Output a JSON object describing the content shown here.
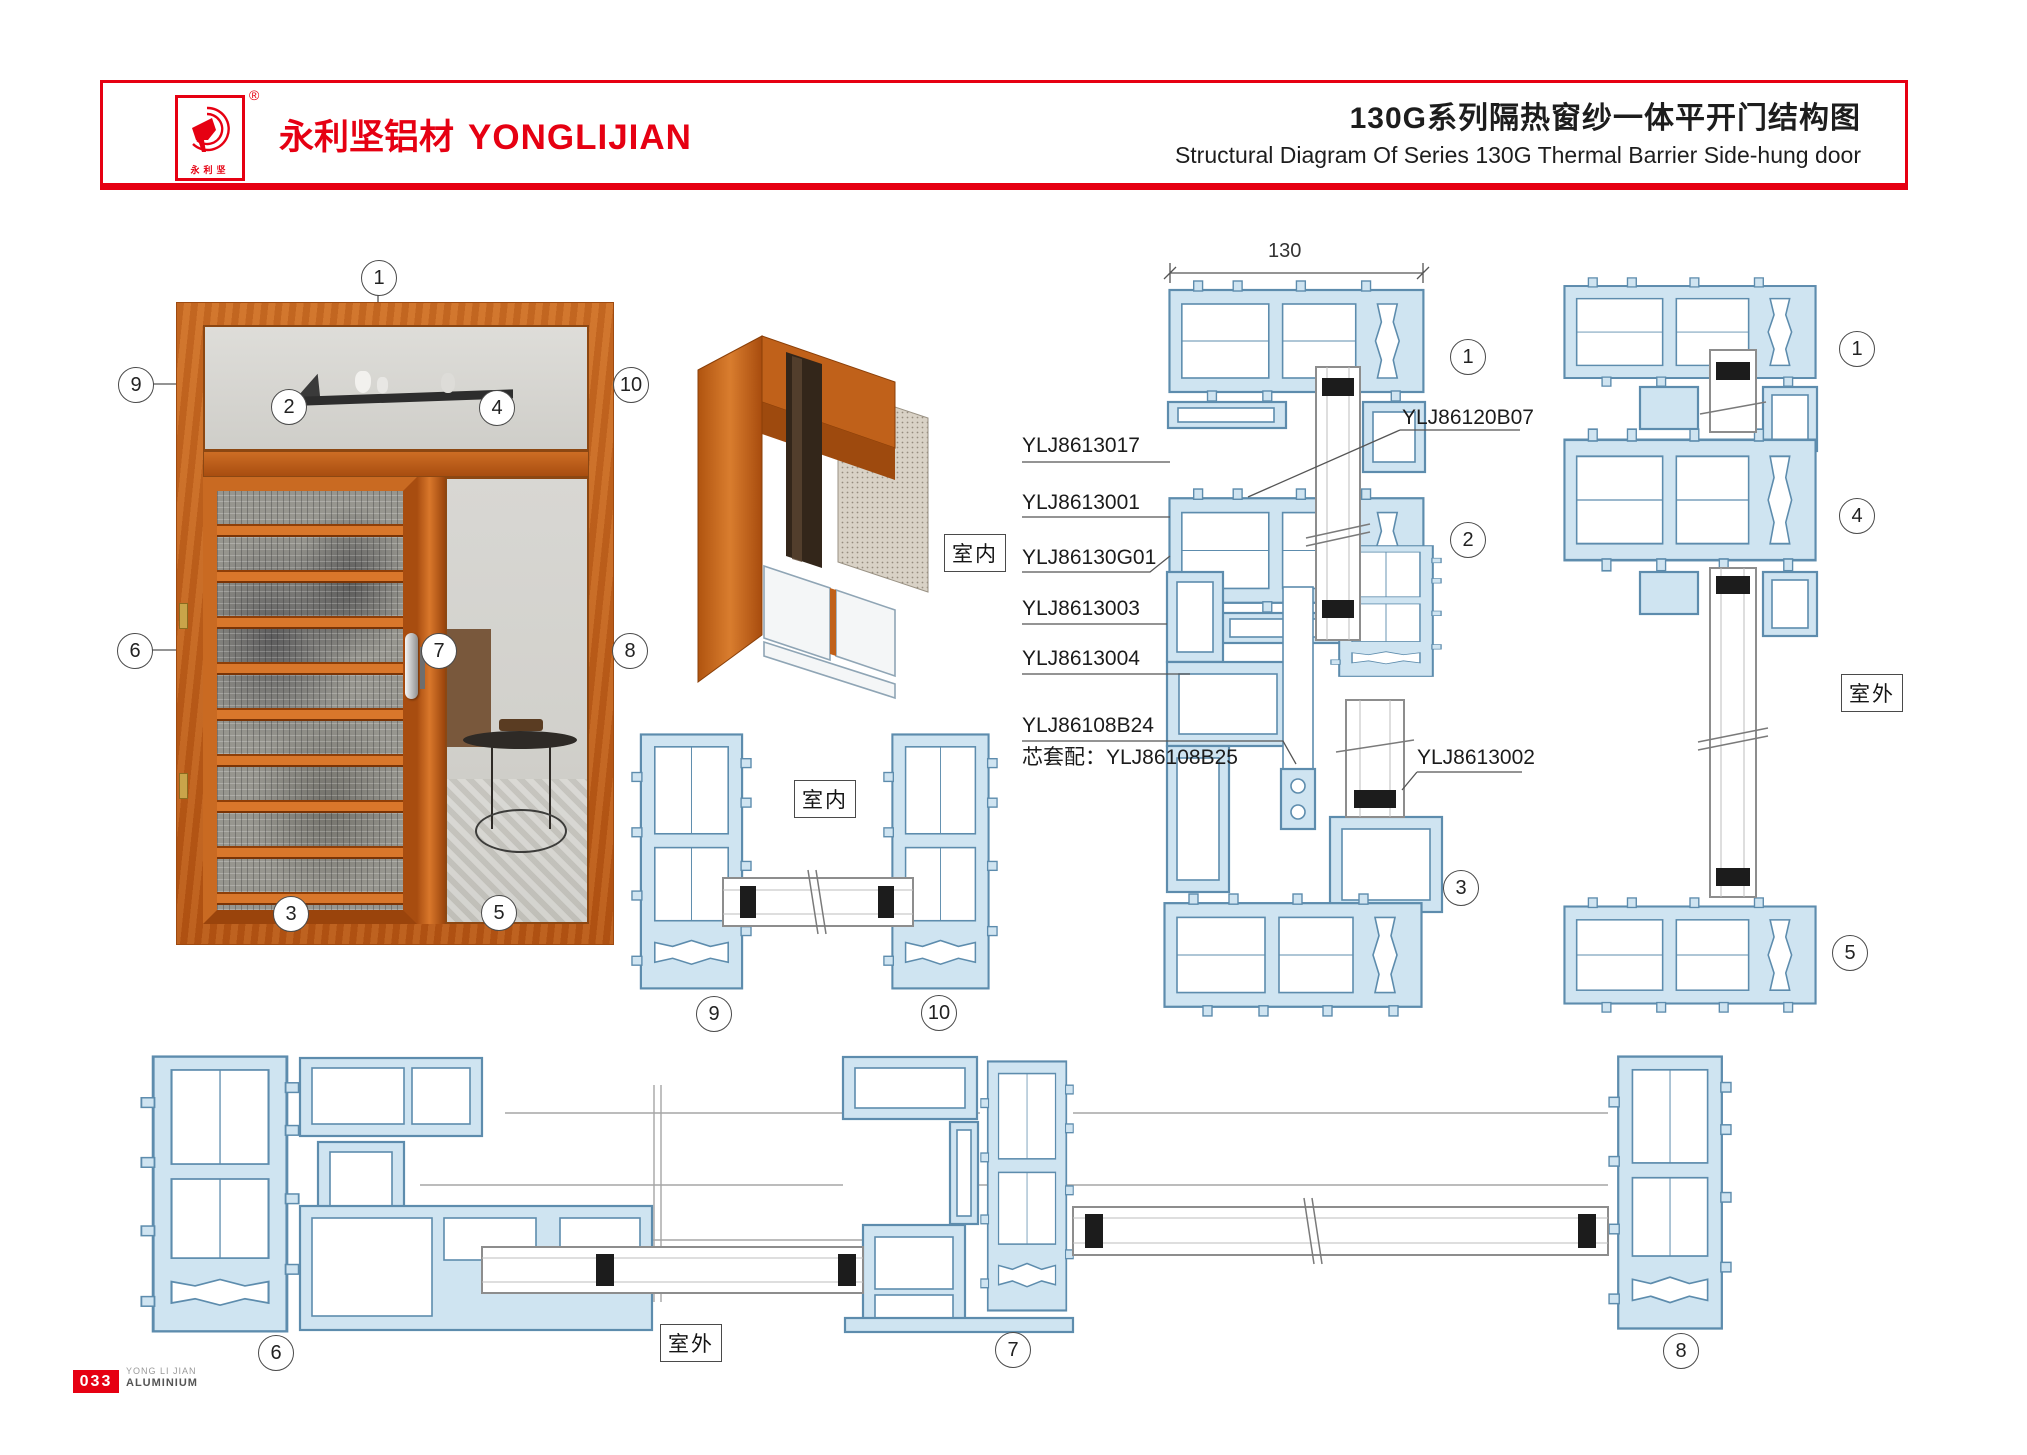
{
  "header": {
    "brand_cn": "永利坚铝材",
    "brand_en": "YONGLIJIAN",
    "logo_chars": "永利坚",
    "registered": "®",
    "title_cn": "130G系列隔热窗纱一体平开门结构图",
    "title_en": "Structural Diagram Of Series 130G Thermal Barrier Side-hung door"
  },
  "dimension": {
    "width_130": "130"
  },
  "area_labels": {
    "indoor": "室内",
    "outdoor": "室外"
  },
  "part_labels": {
    "l1": "YLJ8613017",
    "l2": "YLJ8613001",
    "l3": "YLJ86130G01",
    "l4": "YLJ8613003",
    "l5": "YLJ8613004",
    "l6": "YLJ86108B24",
    "l7": "芯套配：YLJ86108B25",
    "r1": "YLJ86120B07",
    "r2": "YLJ8613002"
  },
  "callouts": {
    "c1": "1",
    "c2": "2",
    "c3": "3",
    "c4": "4",
    "c5": "5",
    "c6": "6",
    "c7": "7",
    "c8": "8",
    "c9": "9",
    "c10": "10"
  },
  "footer": {
    "page": "033",
    "brand_top": "YONG LI JIAN",
    "brand_bottom": "ALUMINIUM"
  },
  "colors": {
    "red": "#e60012",
    "profile_stroke": "#5d8cad",
    "profile_fill": "#cfe4f1"
  }
}
